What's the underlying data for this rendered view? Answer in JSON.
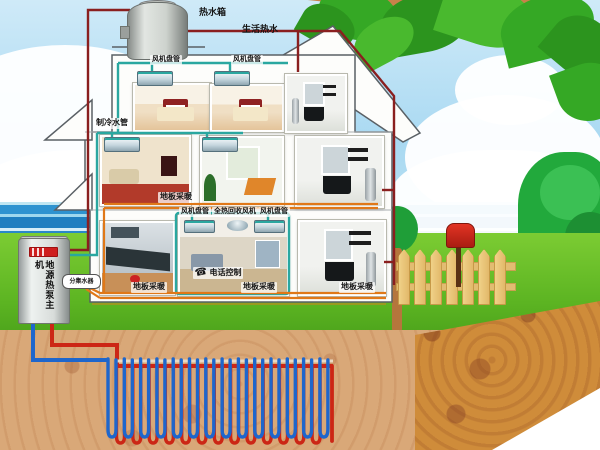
{
  "labels": {
    "hot_water_tank": "热水箱",
    "domestic_hot_water": "生活热水",
    "fan_coil": "风机盘管",
    "chilled_water_pipe": "制冷水管",
    "floor_heating": "地板采暖",
    "total_heat_recovery_fan": "全热回收风机",
    "phone_control": "电话控制",
    "ground_source_heat_pump": "地源热泵主机",
    "manifold": "分集水器"
  },
  "icons": {
    "phone": "☎"
  },
  "colors": {
    "hot_water_pipe": "#8a1f1f",
    "chilled_water_pipe": "#2aa7a0",
    "ground_loop_supply_red": "#cc2615",
    "ground_loop_return_blue": "#1e66cc",
    "floor_heating_pipe": "#e07818",
    "grass": "#5cb422",
    "soil": "#d9a878",
    "soil_side": "#cf8c3a",
    "sky": "#a9d9f2",
    "sea": "#2a88c8",
    "foliage": "#35a825",
    "mailbox_red": "#c9281a",
    "fence_wood": "#e8c878"
  },
  "ground_loop": {
    "u_tube_count": 14,
    "pattern": "alternating red supply / blue return vertical U-tubes"
  }
}
